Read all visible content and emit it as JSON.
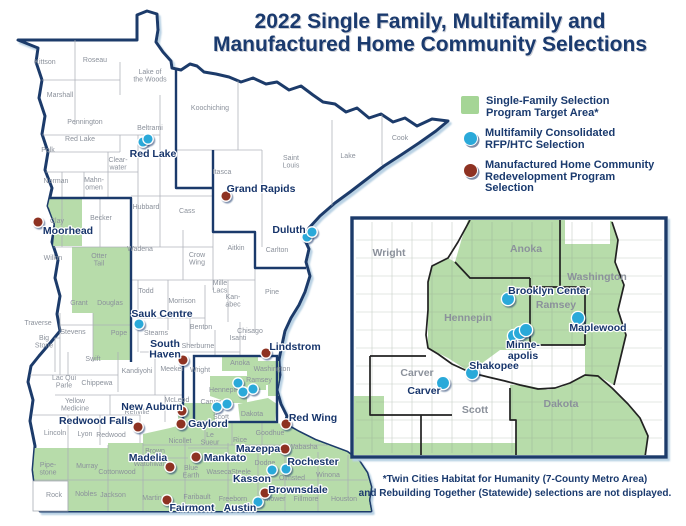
{
  "title": {
    "line1": "2022 Single Family, Multifamily and",
    "line2": "Manufactured Home Community Selections"
  },
  "legend": {
    "items": [
      {
        "id": "single-family-target-area",
        "swatch": "square",
        "color": "#a5d596",
        "lines": [
          "Single-Family Selection",
          "Program Target Area*"
        ]
      },
      {
        "id": "multifamily-rfp-htc",
        "swatch": "circle",
        "color": "#2ba9d9",
        "lines": [
          "Multifamily Consolidated",
          "RFP/HTC Selection"
        ]
      },
      {
        "id": "manufactured-home",
        "swatch": "circle",
        "color": "#8e3222",
        "lines": [
          "Manufactured Home Community",
          "Redevelopment Program",
          "Selection"
        ]
      }
    ]
  },
  "footnote": {
    "line1": "*Twin Cities Habitat for Humanity (7-County Metro Area)",
    "line2": "and Rebuilding Together (Statewide) selections are not displayed."
  },
  "colors": {
    "navy": "#1b3a6b",
    "target_green": "#b7dcaa",
    "multifamily": "#2ba9d9",
    "manufactured": "#8e3222",
    "county_line": "#a8adb5",
    "county_text": "#8b919b",
    "water": "#b9d2e4"
  },
  "main_map": {
    "county_labels": [
      {
        "t": "Kittson",
        "x": 45,
        "y": 64
      },
      {
        "t": "Roseau",
        "x": 95,
        "y": 62
      },
      {
        "t": [
          "Lake of",
          "the Woods"
        ],
        "x": 150,
        "y": 74
      },
      {
        "t": "Marshall",
        "x": 60,
        "y": 97
      },
      {
        "t": "Koochiching",
        "x": 210,
        "y": 110
      },
      {
        "t": "Pennington",
        "x": 85,
        "y": 124
      },
      {
        "t": "Red Lake",
        "x": 80,
        "y": 141
      },
      {
        "t": "Polk",
        "x": 48,
        "y": 152
      },
      {
        "t": "Beltrami",
        "x": 150,
        "y": 130
      },
      {
        "t": [
          "Clear-",
          "water"
        ],
        "x": 118,
        "y": 162
      },
      {
        "t": "Itasca",
        "x": 222,
        "y": 174
      },
      {
        "t": [
          "Saint",
          "Louis"
        ],
        "x": 291,
        "y": 160
      },
      {
        "t": "Lake",
        "x": 348,
        "y": 158
      },
      {
        "t": "Cook",
        "x": 400,
        "y": 140
      },
      {
        "t": "Norman",
        "x": 56,
        "y": 183
      },
      {
        "t": [
          "Mahn-",
          "omen"
        ],
        "x": 94,
        "y": 182
      },
      {
        "t": "Hubbard",
        "x": 146,
        "y": 209
      },
      {
        "t": "Cass",
        "x": 187,
        "y": 213
      },
      {
        "t": "Clay",
        "x": 57,
        "y": 223
      },
      {
        "t": "Becker",
        "x": 101,
        "y": 220
      },
      {
        "t": "Wadena",
        "x": 140,
        "y": 251
      },
      {
        "t": [
          "Otter",
          "Tail"
        ],
        "x": 99,
        "y": 258
      },
      {
        "t": "Wilkin",
        "x": 53,
        "y": 260
      },
      {
        "t": [
          "Crow",
          "Wing"
        ],
        "x": 197,
        "y": 257
      },
      {
        "t": "Aitkin",
        "x": 236,
        "y": 250
      },
      {
        "t": "Carlton",
        "x": 277,
        "y": 252
      },
      {
        "t": "Grant",
        "x": 79,
        "y": 305
      },
      {
        "t": "Douglas",
        "x": 110,
        "y": 305
      },
      {
        "t": "Todd",
        "x": 146,
        "y": 293
      },
      {
        "t": "Morrison",
        "x": 182,
        "y": 303
      },
      {
        "t": [
          "Mille",
          "Lacs"
        ],
        "x": 220,
        "y": 285
      },
      {
        "t": [
          "Kan-",
          "abec"
        ],
        "x": 233,
        "y": 299
      },
      {
        "t": "Pine",
        "x": 272,
        "y": 294
      },
      {
        "t": "Traverse",
        "x": 38,
        "y": 325
      },
      {
        "t": "Stevens",
        "x": 73,
        "y": 334
      },
      {
        "t": "Pope",
        "x": 119,
        "y": 335
      },
      {
        "t": [
          "Big",
          "Stone"
        ],
        "x": 44,
        "y": 340
      },
      {
        "t": "Stearns",
        "x": 156,
        "y": 335
      },
      {
        "t": "Benton",
        "x": 201,
        "y": 329
      },
      {
        "t": "Sherburne",
        "x": 198,
        "y": 348
      },
      {
        "t": "Isanti",
        "x": 238,
        "y": 340
      },
      {
        "t": "Chisago",
        "x": 250,
        "y": 333
      },
      {
        "t": "Swift",
        "x": 93,
        "y": 361
      },
      {
        "t": "Kandiyohi",
        "x": 137,
        "y": 373
      },
      {
        "t": "Meeker",
        "x": 172,
        "y": 371
      },
      {
        "t": "Wright",
        "x": 200,
        "y": 372
      },
      {
        "t": [
          "Lac Qui",
          "Parle"
        ],
        "x": 64,
        "y": 380
      },
      {
        "t": "Chippewa",
        "x": 97,
        "y": 385
      },
      {
        "t": [
          "Yellow",
          "Medicine"
        ],
        "x": 75,
        "y": 403
      },
      {
        "t": "Renville",
        "x": 137,
        "y": 414
      },
      {
        "t": "McLeod",
        "x": 177,
        "y": 402
      },
      {
        "t": "Carver",
        "x": 211,
        "y": 404
      },
      {
        "t": "Scott",
        "x": 221,
        "y": 419
      },
      {
        "t": "Anoka",
        "x": 240,
        "y": 365
      },
      {
        "t": "Washington",
        "x": 272,
        "y": 371
      },
      {
        "t": "Hennepin",
        "x": 224,
        "y": 392
      },
      {
        "t": "Ramsey",
        "x": 259,
        "y": 382
      },
      {
        "t": "Dakota",
        "x": 252,
        "y": 416
      },
      {
        "t": "Lincoln",
        "x": 55,
        "y": 435
      },
      {
        "t": "Lyon",
        "x": 85,
        "y": 436
      },
      {
        "t": "Redwood",
        "x": 111,
        "y": 437
      },
      {
        "t": "Nicollet",
        "x": 180,
        "y": 443
      },
      {
        "t": [
          "Le",
          "Sueur"
        ],
        "x": 210,
        "y": 437
      },
      {
        "t": "Rice",
        "x": 240,
        "y": 442
      },
      {
        "t": "Goodhue",
        "x": 270,
        "y": 435
      },
      {
        "t": "Wabasha",
        "x": 303,
        "y": 449
      },
      {
        "t": "Brown",
        "x": 155,
        "y": 453
      },
      {
        "t": [
          "Blue",
          "Earth"
        ],
        "x": 191,
        "y": 470
      },
      {
        "t": "Waseca",
        "x": 219,
        "y": 474
      },
      {
        "t": "Steele",
        "x": 241,
        "y": 474
      },
      {
        "t": "Dodge",
        "x": 265,
        "y": 465
      },
      {
        "t": "Olmsted",
        "x": 292,
        "y": 480
      },
      {
        "t": "Winona",
        "x": 328,
        "y": 477
      },
      {
        "t": [
          "Pipe-",
          "stone"
        ],
        "x": 48,
        "y": 467
      },
      {
        "t": "Murray",
        "x": 87,
        "y": 468
      },
      {
        "t": "Cottonwood",
        "x": 117,
        "y": 474
      },
      {
        "t": "Watonwan",
        "x": 150,
        "y": 466
      },
      {
        "t": "Rock",
        "x": 54,
        "y": 497
      },
      {
        "t": "Nobles",
        "x": 86,
        "y": 496
      },
      {
        "t": "Jackson",
        "x": 113,
        "y": 497
      },
      {
        "t": "Martin",
        "x": 152,
        "y": 500
      },
      {
        "t": "Faribault",
        "x": 197,
        "y": 499
      },
      {
        "t": "Freeborn",
        "x": 233,
        "y": 501
      },
      {
        "t": "Mower",
        "x": 275,
        "y": 501
      },
      {
        "t": "Fillmore",
        "x": 306,
        "y": 501
      },
      {
        "t": "Houston",
        "x": 344,
        "y": 501
      }
    ],
    "markers_multifamily": [
      {
        "name": "red-lake",
        "x": 143,
        "y": 142
      },
      {
        "name": "red-lake-2",
        "x": 148,
        "y": 139
      },
      {
        "name": "duluth",
        "x": 307,
        "y": 237
      },
      {
        "name": "duluth-2",
        "x": 312,
        "y": 232
      },
      {
        "name": "sauk-centre",
        "x": 139,
        "y": 324
      },
      {
        "name": "metro-1",
        "x": 238,
        "y": 383
      },
      {
        "name": "metro-2",
        "x": 243,
        "y": 392
      },
      {
        "name": "metro-3",
        "x": 253,
        "y": 389
      },
      {
        "name": "metro-4",
        "x": 217,
        "y": 407
      },
      {
        "name": "metro-5",
        "x": 227,
        "y": 404
      },
      {
        "name": "kasson",
        "x": 272,
        "y": 470
      },
      {
        "name": "rochester",
        "x": 286,
        "y": 469
      },
      {
        "name": "austin",
        "x": 258,
        "y": 502
      }
    ],
    "markers_manufactured": [
      {
        "name": "moorhead",
        "x": 38,
        "y": 222
      },
      {
        "name": "grand-rapids",
        "x": 226,
        "y": 196
      },
      {
        "name": "south-haven",
        "x": 183,
        "y": 360
      },
      {
        "name": "lindstrom",
        "x": 266,
        "y": 353
      },
      {
        "name": "new-auburn",
        "x": 182,
        "y": 411
      },
      {
        "name": "gaylord",
        "x": 181,
        "y": 424
      },
      {
        "name": "redwood-falls",
        "x": 138,
        "y": 427
      },
      {
        "name": "red-wing",
        "x": 286,
        "y": 424
      },
      {
        "name": "madelia",
        "x": 170,
        "y": 467
      },
      {
        "name": "mankato",
        "x": 196,
        "y": 457
      },
      {
        "name": "mazeppa",
        "x": 285,
        "y": 449
      },
      {
        "name": "brownsdale",
        "x": 265,
        "y": 493
      },
      {
        "name": "fairmont",
        "x": 167,
        "y": 500
      }
    ],
    "city_labels": [
      {
        "t": "Red Lake",
        "x": 153,
        "y": 157
      },
      {
        "t": "Moorhead",
        "x": 68,
        "y": 234
      },
      {
        "t": "Grand Rapids",
        "x": 261,
        "y": 192
      },
      {
        "t": "Duluth",
        "x": 289,
        "y": 233
      },
      {
        "t": "Sauk Centre",
        "x": 162,
        "y": 317
      },
      {
        "t": [
          "South",
          "Haven"
        ],
        "x": 165,
        "y": 347
      },
      {
        "t": "Lindstrom",
        "x": 295,
        "y": 350
      },
      {
        "t": "New Auburn",
        "x": 152,
        "y": 410
      },
      {
        "t": "Gaylord",
        "x": 208,
        "y": 427
      },
      {
        "t": "Redwood Falls",
        "x": 96,
        "y": 424
      },
      {
        "t": "Red Wing",
        "x": 313,
        "y": 421
      },
      {
        "t": "Madelia",
        "x": 148,
        "y": 461
      },
      {
        "t": "Mankato",
        "x": 225,
        "y": 461
      },
      {
        "t": "Mazeppa",
        "x": 258,
        "y": 452
      },
      {
        "t": "Rochester",
        "x": 313,
        "y": 465
      },
      {
        "t": "Kasson",
        "x": 252,
        "y": 482
      },
      {
        "t": "Brownsdale",
        "x": 298,
        "y": 493
      },
      {
        "t": "Austin",
        "x": 240,
        "y": 511
      },
      {
        "t": "Fairmont",
        "x": 192,
        "y": 511
      }
    ]
  },
  "inset_map": {
    "county_labels": [
      {
        "t": "Wright",
        "x": 389,
        "y": 256
      },
      {
        "t": "Anoka",
        "x": 526,
        "y": 252
      },
      {
        "t": "Washington",
        "x": 597,
        "y": 280
      },
      {
        "t": "Hennepin",
        "x": 468,
        "y": 321
      },
      {
        "t": "Ramsey",
        "x": 556,
        "y": 308
      },
      {
        "t": "Carver",
        "x": 417,
        "y": 376
      },
      {
        "t": "Scott",
        "x": 475,
        "y": 413
      },
      {
        "t": "Dakota",
        "x": 561,
        "y": 407
      }
    ],
    "markers_multifamily": [
      {
        "name": "brooklyn-center",
        "x": 508,
        "y": 299
      },
      {
        "name": "maplewood",
        "x": 578,
        "y": 318
      },
      {
        "name": "minneapolis-1",
        "x": 514,
        "y": 336
      },
      {
        "name": "minneapolis-2",
        "x": 520,
        "y": 333
      },
      {
        "name": "minneapolis-3",
        "x": 526,
        "y": 330
      },
      {
        "name": "shakopee",
        "x": 472,
        "y": 373
      },
      {
        "name": "carver",
        "x": 443,
        "y": 383
      }
    ],
    "city_labels": [
      {
        "t": "Brooklyn Center",
        "x": 549,
        "y": 294
      },
      {
        "t": "Maplewood",
        "x": 598,
        "y": 331
      },
      {
        "t": [
          "Minne-",
          "apolis"
        ],
        "x": 523,
        "y": 348
      },
      {
        "t": "Shakopee",
        "x": 494,
        "y": 369
      },
      {
        "t": "Carver",
        "x": 424,
        "y": 394
      }
    ]
  }
}
